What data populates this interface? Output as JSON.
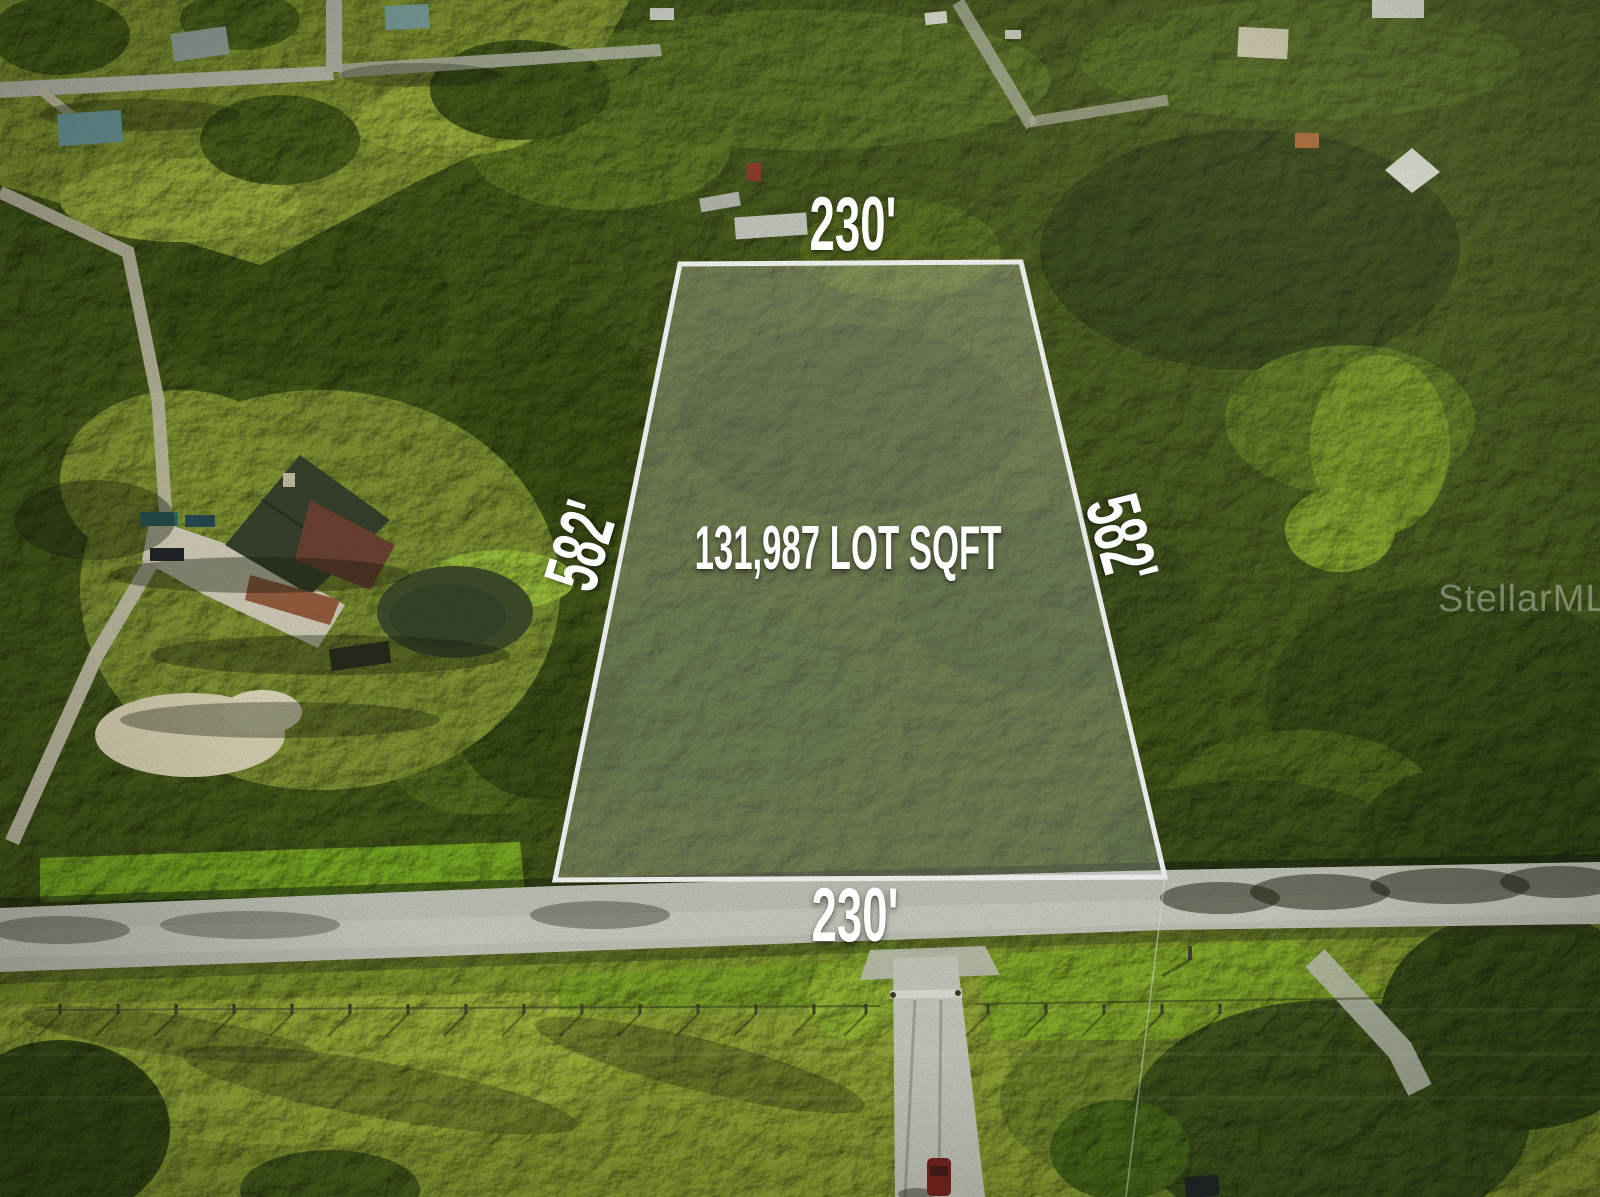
{
  "photo": {
    "watermark": {
      "text": "StellarMLS",
      "color": "rgba(255,255,255,0.35)"
    }
  },
  "lot_overlay": {
    "area_label": "131,987 LOT SQFT",
    "dimensions": {
      "top": "230'",
      "bottom": "230'",
      "left": "582'",
      "right": "582'"
    },
    "outline_color": "#ffffff",
    "fill_color": "rgba(255,255,255,0.25)",
    "text_color": "#ffffff"
  }
}
